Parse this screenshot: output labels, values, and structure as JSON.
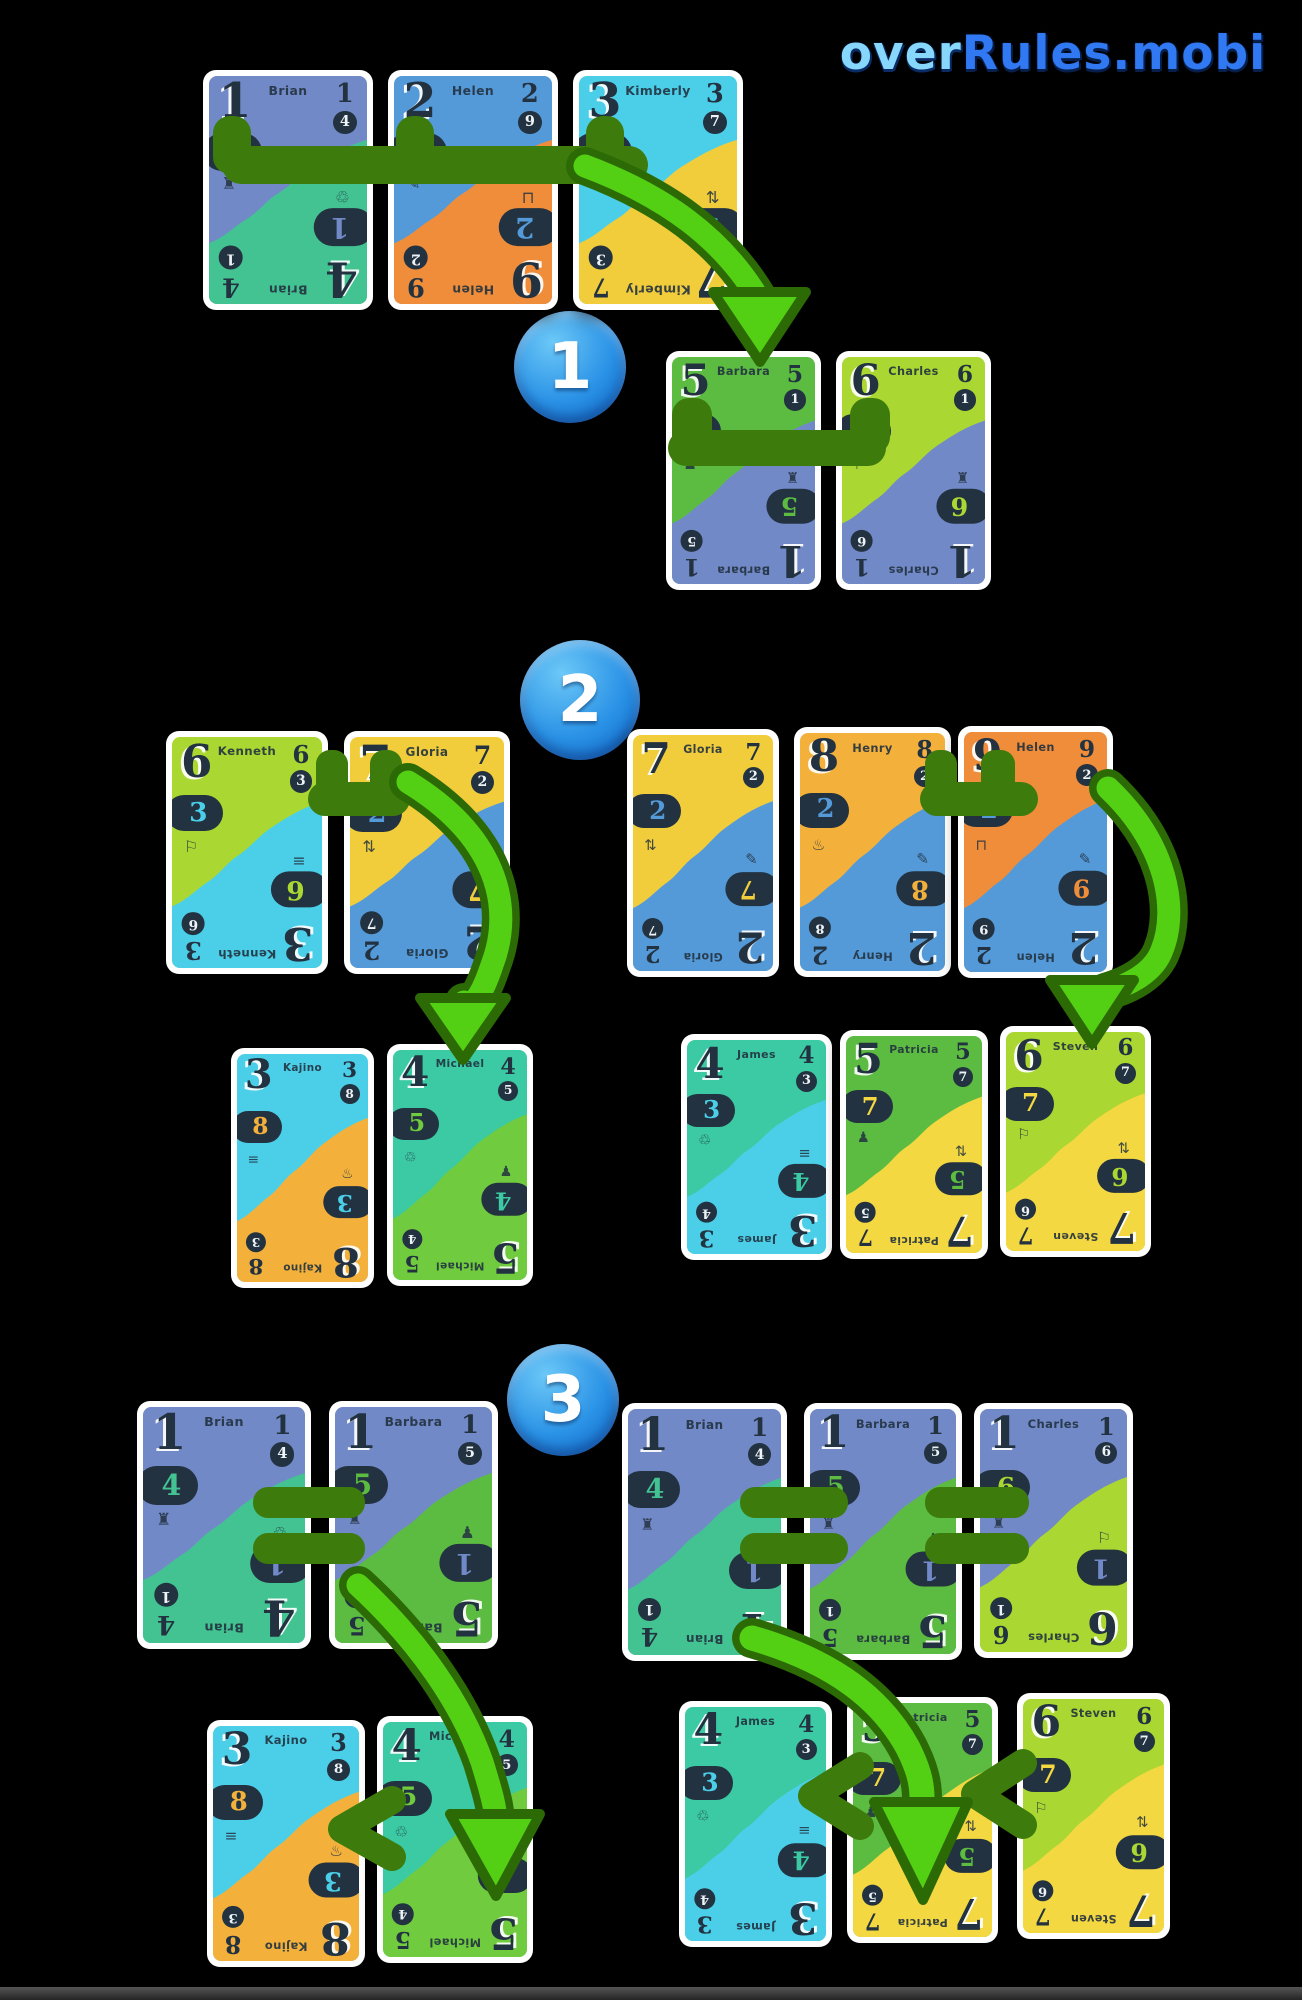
{
  "logo": {
    "text_light": "over",
    "text_dark": "Rules.mobi"
  },
  "steps": [
    {
      "label": "1"
    },
    {
      "label": "2"
    },
    {
      "label": "3"
    }
  ],
  "palette": {
    "ink": "#233240",
    "card_border": "#ffffff",
    "link_green": "#3d7b0c",
    "arrow_green": "#54d014",
    "arrow_outline": "#2c6a06",
    "step_blue_light": "#6cc8f7",
    "step_blue_dark": "#0d62c4",
    "logo_light": "#86d7fb",
    "logo_dark": "#3079f2",
    "colors": {
      "slate": "#7289c7",
      "mint": "#43c392",
      "blue": "#549ad8",
      "orange": "#ef8d3a",
      "cyan": "#4bcfe9",
      "yellow": "#f1cd3c",
      "green": "#5cbc41",
      "lime": "#abd732",
      "amber": "#f3b13c",
      "teal": "#3bcaa3",
      "lightgreen": "#70cc3e",
      "paleyellow": "#f3d841"
    }
  },
  "icons": {
    "bus": "♜",
    "flashlight": "✎",
    "film": "≡",
    "recycle": "♲",
    "unicycle": "♟",
    "balloon": "⚐",
    "arrows": "⇅",
    "trampoline": "♨",
    "swing": "⊓"
  },
  "cards": {
    "brian": {
      "name": "Brian",
      "top": "1",
      "bottom": "4",
      "topColor": "slate",
      "bottomColor": "mint",
      "leftIcon": "bus",
      "rightIcon": "recycle"
    },
    "helen2": {
      "name": "Helen",
      "top": "2",
      "bottom": "9",
      "topColor": "blue",
      "bottomColor": "orange",
      "leftIcon": "flashlight",
      "rightIcon": "swing"
    },
    "kimberly": {
      "name": "Kimberly",
      "top": "3",
      "bottom": "7",
      "topColor": "cyan",
      "bottomColor": "yellow",
      "leftIcon": "film",
      "rightIcon": "arrows"
    },
    "barbara5": {
      "name": "Barbara",
      "top": "5",
      "bottom": "1",
      "topColor": "green",
      "bottomColor": "slate",
      "leftIcon": "unicycle",
      "rightIcon": "bus"
    },
    "charles6": {
      "name": "Charles",
      "top": "6",
      "bottom": "1",
      "topColor": "lime",
      "bottomColor": "slate",
      "leftIcon": "balloon",
      "rightIcon": "bus"
    },
    "kenneth": {
      "name": "Kenneth",
      "top": "6",
      "bottom": "3",
      "topColor": "lime",
      "bottomColor": "cyan",
      "leftIcon": "balloon",
      "rightIcon": "film"
    },
    "gloria": {
      "name": "Gloria",
      "top": "7",
      "bottom": "2",
      "topColor": "yellow",
      "bottomColor": "blue",
      "leftIcon": "arrows",
      "rightIcon": "flashlight"
    },
    "henry": {
      "name": "Henry",
      "top": "8",
      "bottom": "2",
      "topColor": "amber",
      "bottomColor": "blue",
      "leftIcon": "trampoline",
      "rightIcon": "flashlight"
    },
    "helen9": {
      "name": "Helen",
      "top": "9",
      "bottom": "2",
      "topColor": "orange",
      "bottomColor": "blue",
      "leftIcon": "swing",
      "rightIcon": "flashlight"
    },
    "kajino": {
      "name": "Kajino",
      "top": "3",
      "bottom": "8",
      "topColor": "cyan",
      "bottomColor": "amber",
      "leftIcon": "film",
      "rightIcon": "trampoline"
    },
    "michael": {
      "name": "Michael",
      "top": "4",
      "bottom": "5",
      "topColor": "teal",
      "bottomColor": "lightgreen",
      "leftIcon": "recycle",
      "rightIcon": "unicycle"
    },
    "james": {
      "name": "James",
      "top": "4",
      "bottom": "3",
      "topColor": "teal",
      "bottomColor": "cyan",
      "leftIcon": "recycle",
      "rightIcon": "film"
    },
    "patricia": {
      "name": "Patricia",
      "top": "5",
      "bottom": "7",
      "topColor": "green",
      "bottomColor": "paleyellow",
      "leftIcon": "unicycle",
      "rightIcon": "arrows"
    },
    "steven": {
      "name": "Steven",
      "top": "6",
      "bottom": "7",
      "topColor": "lime",
      "bottomColor": "paleyellow",
      "leftIcon": "balloon",
      "rightIcon": "arrows"
    },
    "barbara1": {
      "name": "Barbara",
      "top": "1",
      "bottom": "5",
      "topColor": "slate",
      "bottomColor": "green",
      "leftIcon": "bus",
      "rightIcon": "unicycle"
    },
    "charles1": {
      "name": "Charles",
      "top": "1",
      "bottom": "6",
      "topColor": "slate",
      "bottomColor": "lime",
      "leftIcon": "bus",
      "rightIcon": "balloon"
    }
  },
  "board": {
    "step_badges": [
      {
        "x": 514,
        "y": 311,
        "d": 112
      },
      {
        "x": 520,
        "y": 640,
        "d": 120
      },
      {
        "x": 507,
        "y": 1344,
        "d": 112
      }
    ],
    "instances": [
      {
        "card": "brian",
        "group": "step1-hand",
        "x": 203,
        "y": 70,
        "w": 170,
        "h": 240
      },
      {
        "card": "helen2",
        "group": "step1-hand",
        "x": 388,
        "y": 70,
        "w": 170,
        "h": 240
      },
      {
        "card": "kimberly",
        "group": "step1-hand",
        "x": 573,
        "y": 70,
        "w": 170,
        "h": 240
      },
      {
        "card": "barbara5",
        "group": "step1-result",
        "x": 666,
        "y": 351,
        "w": 155,
        "h": 239
      },
      {
        "card": "charles6",
        "group": "step1-result",
        "x": 836,
        "y": 351,
        "w": 155,
        "h": 239
      },
      {
        "card": "kenneth",
        "group": "step2-left-hand",
        "x": 166,
        "y": 731,
        "w": 162,
        "h": 243
      },
      {
        "card": "gloria",
        "group": "step2-left-hand",
        "x": 344,
        "y": 731,
        "w": 166,
        "h": 243
      },
      {
        "card": "gloria",
        "group": "step2-right-hand",
        "x": 627,
        "y": 729,
        "w": 152,
        "h": 248
      },
      {
        "card": "henry",
        "group": "step2-right-hand",
        "x": 794,
        "y": 727,
        "w": 157,
        "h": 250
      },
      {
        "card": "helen9",
        "group": "step2-right-hand",
        "x": 958,
        "y": 726,
        "w": 155,
        "h": 252
      },
      {
        "card": "kajino",
        "group": "step2-left-result",
        "x": 231,
        "y": 1048,
        "w": 143,
        "h": 240
      },
      {
        "card": "michael",
        "group": "step2-left-result",
        "x": 387,
        "y": 1044,
        "w": 146,
        "h": 242
      },
      {
        "card": "james",
        "group": "step2-right-result",
        "x": 681,
        "y": 1034,
        "w": 151,
        "h": 226
      },
      {
        "card": "patricia",
        "group": "step2-right-result",
        "x": 840,
        "y": 1030,
        "w": 148,
        "h": 229
      },
      {
        "card": "steven",
        "group": "step2-right-result",
        "x": 1000,
        "y": 1026,
        "w": 151,
        "h": 231
      },
      {
        "card": "brian",
        "group": "step3-left-hand",
        "x": 137,
        "y": 1401,
        "w": 174,
        "h": 248
      },
      {
        "card": "barbara1",
        "group": "step3-left-hand",
        "x": 329,
        "y": 1401,
        "w": 169,
        "h": 248
      },
      {
        "card": "brian",
        "group": "step3-right-hand",
        "x": 622,
        "y": 1403,
        "w": 165,
        "h": 258
      },
      {
        "card": "barbara1",
        "group": "step3-right-hand",
        "x": 804,
        "y": 1403,
        "w": 158,
        "h": 257
      },
      {
        "card": "charles1",
        "group": "step3-right-hand",
        "x": 974,
        "y": 1403,
        "w": 159,
        "h": 255
      },
      {
        "card": "kajino",
        "group": "step3-left-result",
        "x": 207,
        "y": 1720,
        "w": 158,
        "h": 247
      },
      {
        "card": "michael",
        "group": "step3-left-result",
        "x": 377,
        "y": 1716,
        "w": 156,
        "h": 247
      },
      {
        "card": "james",
        "group": "step3-right-result",
        "x": 679,
        "y": 1701,
        "w": 153,
        "h": 246
      },
      {
        "card": "patricia",
        "group": "step3-right-result",
        "x": 847,
        "y": 1697,
        "w": 151,
        "h": 246
      },
      {
        "card": "steven",
        "group": "step3-right-result",
        "x": 1017,
        "y": 1693,
        "w": 153,
        "h": 246
      }
    ]
  }
}
